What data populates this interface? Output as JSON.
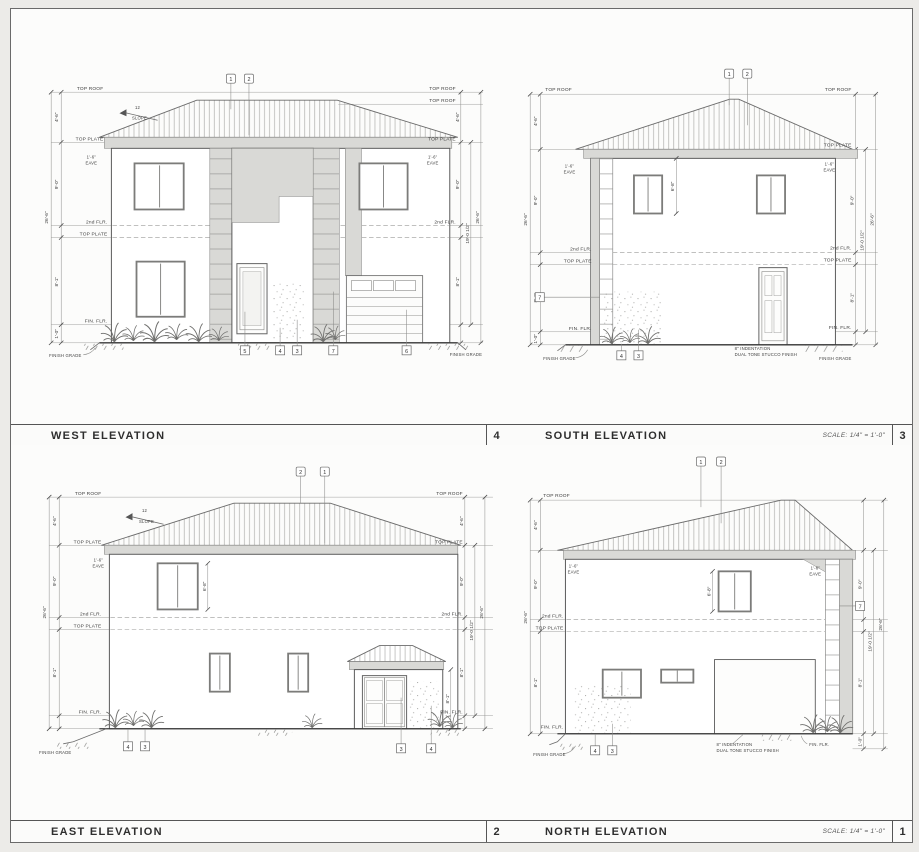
{
  "sheet": {
    "background": "#ecebe8",
    "paper": "#fcfcfb",
    "line_color": "#5c5c5c",
    "shade_color": "#d9d9d6"
  },
  "labels": {
    "top_roof": "TOP ROOF",
    "top_plate": "TOP PLATE",
    "second_flr": "2nd FLR.",
    "fin_flr": "FIN. FLR.",
    "finish_grade": "FINISH GRADE",
    "eave_dim": "1'-6\"",
    "eave_word": "EAVE",
    "slope_rise": "12",
    "slope_word": "SLOPE"
  },
  "dims": {
    "roof": "4'-6\"",
    "story": "9'-0\"",
    "lower": "8'-1\"",
    "grade": "1'-0\"",
    "floors_total": "19'-0 1/2\"",
    "overall": "26'-6\"",
    "window": "6'-8\"",
    "porch": "8'-1\""
  },
  "notes": {
    "indent_line1": "8\" INDENTATION",
    "indent_line2": "DUAL TONE STUCCO FINISH"
  },
  "panels": [
    {
      "title": "WEST ELEVATION",
      "number": "4",
      "scale": "",
      "keynotes_top": [
        "1",
        "2"
      ],
      "keynotes_bottom": [
        "5",
        "4",
        "3",
        "7",
        "6"
      ]
    },
    {
      "title": "SOUTH ELEVATION",
      "number": "3",
      "scale": "SCALE:  1/4\" = 1'-0\"",
      "keynotes_top": [
        "1",
        "2"
      ],
      "keynotes_bottom": [
        "4",
        "3"
      ],
      "keynote_wall": "7"
    },
    {
      "title": "EAST ELEVATION",
      "number": "2",
      "scale": "",
      "keynotes_top": [
        "2",
        "1"
      ],
      "keynotes_bottom": [
        "4",
        "3",
        "3",
        "4"
      ]
    },
    {
      "title": "NORTH ELEVATION",
      "number": "1",
      "scale": "SCALE:  1/4\" = 1'-0\"",
      "keynotes_top": [
        "1",
        "2"
      ],
      "keynotes_bottom": [
        "4",
        "3"
      ],
      "keynote_wall": "7"
    }
  ]
}
